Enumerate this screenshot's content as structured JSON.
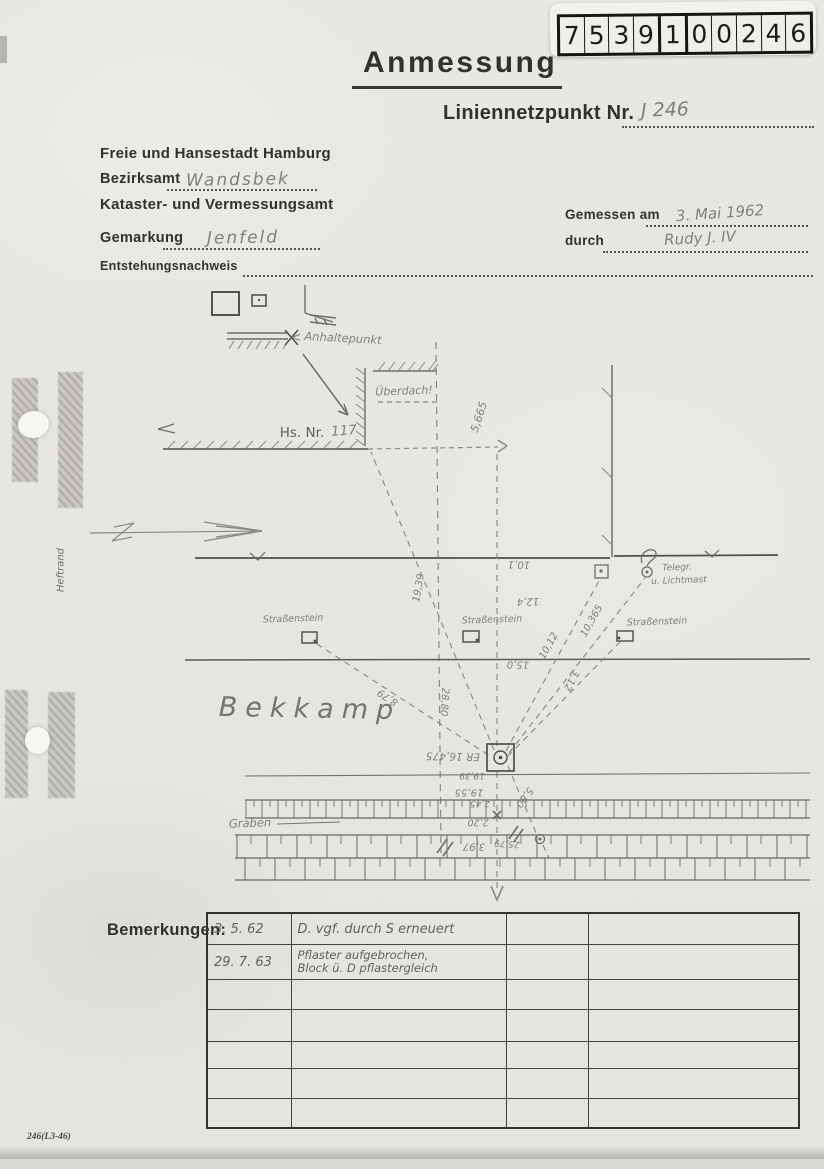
{
  "stamp": {
    "digits": [
      "7",
      "5",
      "3",
      "9",
      "1",
      "0",
      "0",
      "2",
      "4",
      "6"
    ]
  },
  "header": {
    "title": "Anmessung",
    "point_label": "Liniennetzpunkt Nr.",
    "point_value": "J 246",
    "agency_line1": "Freie und Hansestadt Hamburg",
    "district_label": "Bezirksamt",
    "district_value": "Wandsbek",
    "agency_line2": "Kataster- und Vermessungsamt",
    "gemarkung_label": "Gemarkung",
    "gemarkung_value": "Jenfeld",
    "entstehung_label": "Entstehungsnachweis",
    "measured_label": "Gemessen am",
    "measured_value": "3. Mai 1962",
    "by_label": "durch",
    "by_value": "Rudy J. IV"
  },
  "sketch": {
    "labels": {
      "anhalte_arrow": "<",
      "anhaltepunkt": "Anhaltepunkt",
      "ueberdach": "Überdach!",
      "hs_nr": "Hs. Nr.",
      "hs_nr_value": "117",
      "strassenstein": "Straßenstein",
      "telegr_line1": "Telegr.",
      "telegr_line2": "u. Lichtmast",
      "street_name": "Bekkamp",
      "graben": "Graben",
      "heftrand": "Heftrand"
    },
    "measurements": {
      "m5665": "5,665",
      "m10_1": "10,1",
      "m12_4": "12,4",
      "m15_0": "15,0",
      "m19_39": "19,39",
      "m10_12": "10,12",
      "m10_365": "10,365",
      "m3_12": "3,12",
      "m8_79": "8,79",
      "m28_80": "28,80",
      "er": "ER 16,475",
      "m19_39b": "19,39",
      "m19_55": "19,55",
      "m2_45": "2,45",
      "m2_20": "2,20",
      "m5_80": "5,80",
      "m25_79": "25,79",
      "m3_97": "3,97"
    }
  },
  "remarks": {
    "label": "Bemerkungen:",
    "rows": [
      {
        "date": "3. 5. 62",
        "line1": "D. vgf. durch S erneuert",
        "line2": ""
      },
      {
        "date": "29. 7. 63",
        "line1": "Pflaster aufgebrochen,",
        "line2": "Block ü. D pflastergleich"
      }
    ]
  },
  "footer": {
    "form_number": "246(L3-46)"
  }
}
